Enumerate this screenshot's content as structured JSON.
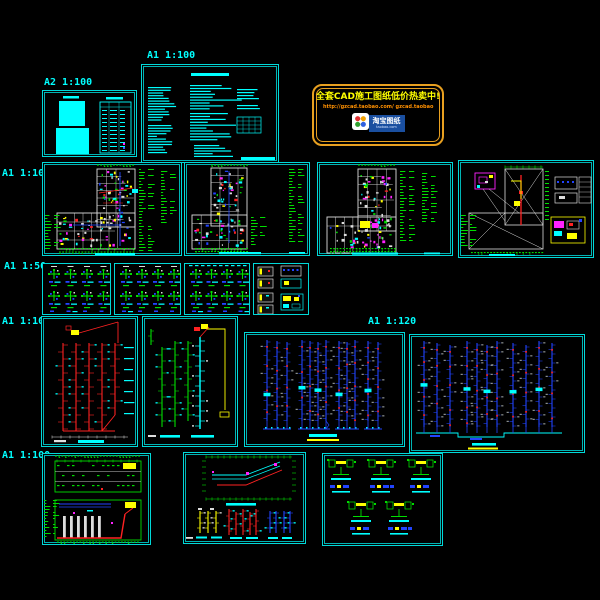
{
  "window": {
    "width": 600,
    "height": 600,
    "background": "#000000"
  },
  "palette": {
    "background": "#000000",
    "sheet_border": "#00d8d8",
    "label_text": "#00ffff",
    "cyan": "#00ffff",
    "green": "#00dd00",
    "red": "#ff2222",
    "blue": "#2244ff",
    "magenta": "#ff22ff",
    "yellow": "#ffff00",
    "white": "#dddddd",
    "gray": "#9aa0a0",
    "banner_border": "#e8a020",
    "banner_headline": "#ffff00",
    "banner_url": "#ff9000"
  },
  "scale_labels": {
    "cover": "A2 1:100",
    "notes": "A1 1:100",
    "plans": "A1 1:100",
    "details": "A1 1:50",
    "risers": "A1 1:100",
    "risers_mid": "A1 1:120",
    "bottom": "A1 1:100"
  },
  "banner": {
    "headline": "全套CAD施工图纸低价热卖中!",
    "url_line": "http://gzcad.taobao.com/ gzcad.taobao",
    "logo_text": "淘宝图纸",
    "logo_subtext": "taobao.com"
  }
}
